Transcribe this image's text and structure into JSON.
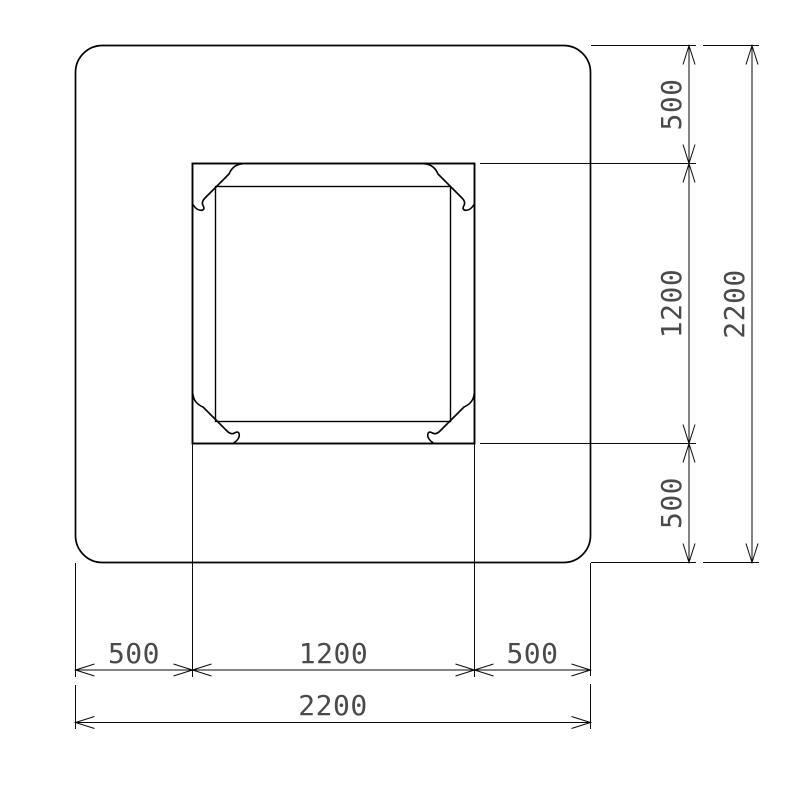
{
  "drawing": {
    "kind": "cad-plan-view",
    "line_color": "#000000",
    "dim_text_color": "#4a4a4a",
    "background_color": "#ffffff",
    "dimensions": {
      "right": {
        "top": "500",
        "middle": "1200",
        "bottom": "500",
        "overall": "2200"
      },
      "bottom": {
        "left": "500",
        "middle": "1200",
        "right": "500",
        "overall": "2200"
      }
    }
  }
}
